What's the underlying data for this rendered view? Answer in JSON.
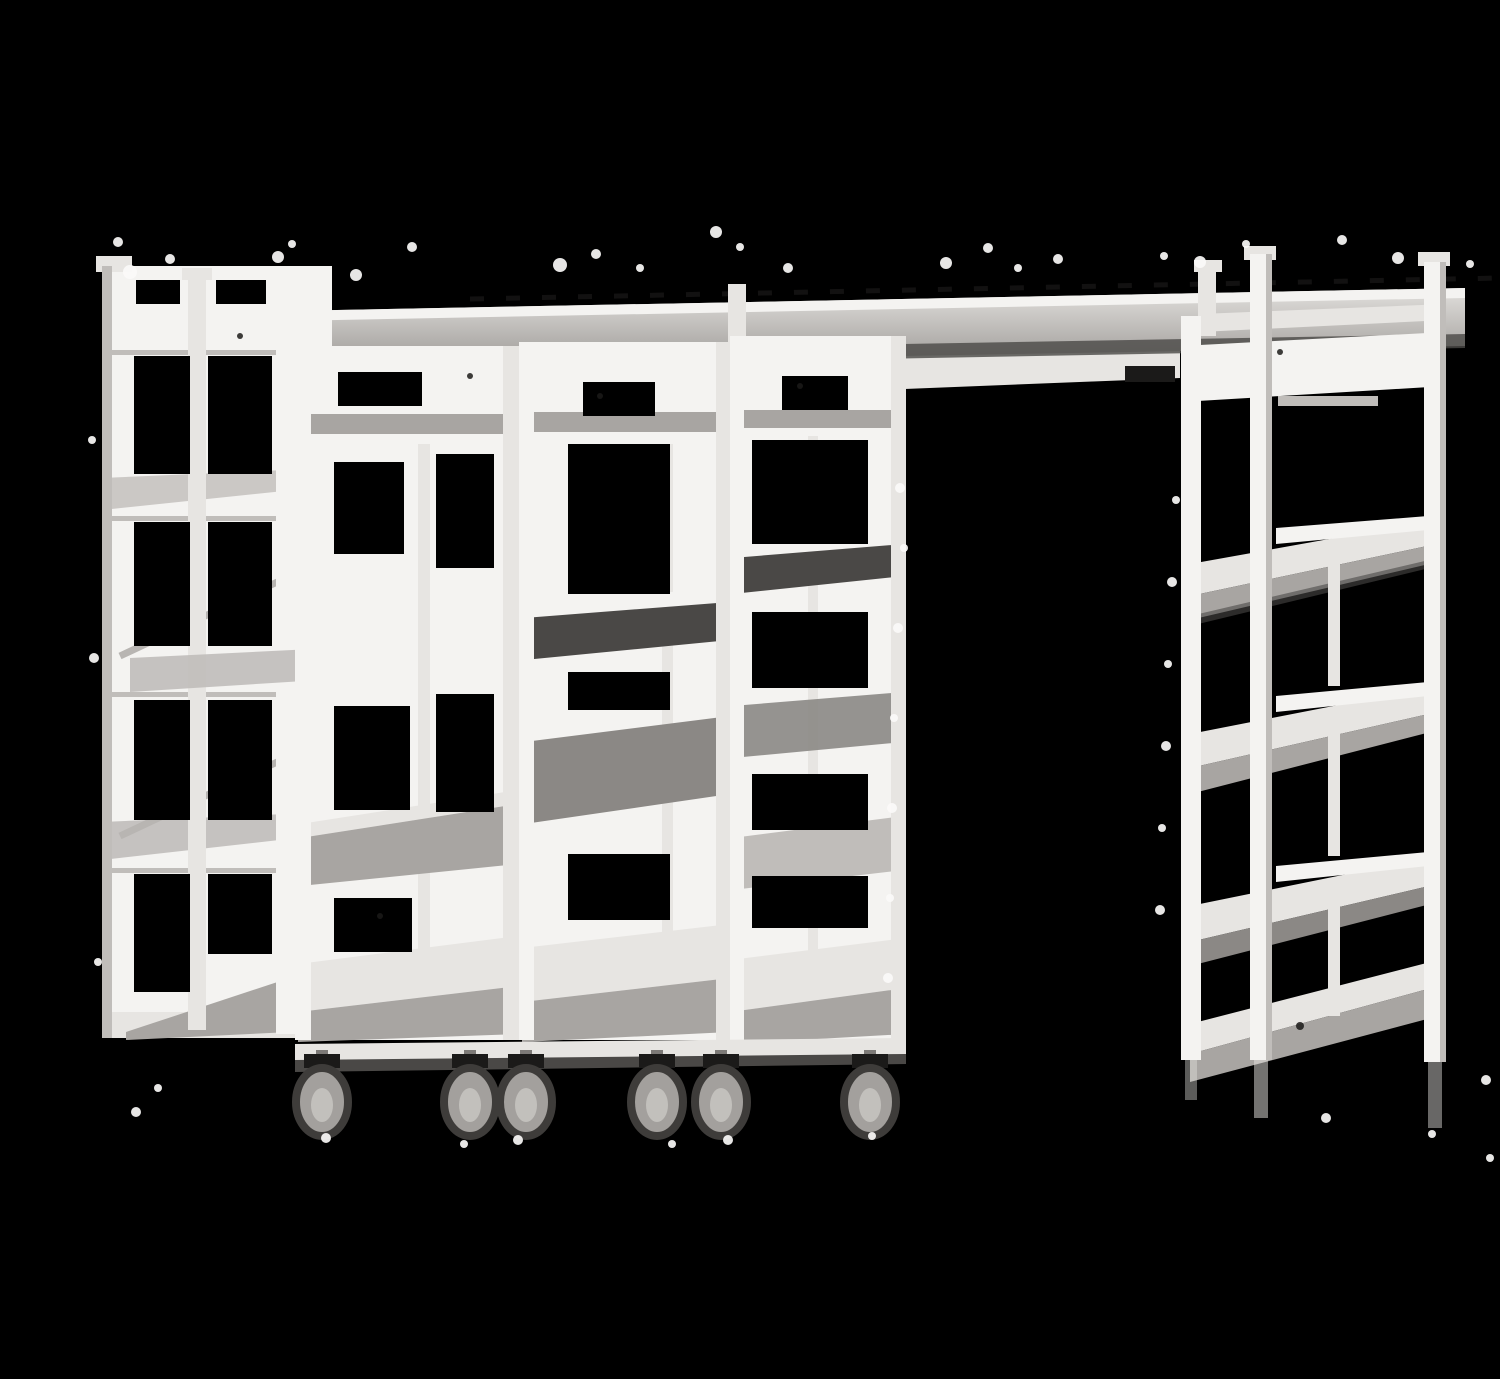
{
  "meta": {
    "kind": "product-photograph",
    "color_mode": "grayscale",
    "width_px": 1500,
    "height_px": 1347
  },
  "scene": {
    "description": "Black-and-white product photograph of a modular high-density mobile shelving system: a long overhead track rail spans the image, connecting a stationary open-frame shelving end unit on the left and a taller stationary end unit on the right. Three wheeled shelf carts are docked side by side beneath the rail, leaving one empty open bay before the right unit. The metal framework is white to light gray against a solid black background; six dark casters hang beneath the carts and white paint-like specks are scattered around the matte edges.",
    "background_color": "#000000"
  },
  "palette": {
    "background_color": "#000000",
    "frame_white": "#f4f3f1",
    "frame_light": "#e7e5e2",
    "frame_mid": "#c0bdba",
    "slab_gray": "#a8a5a2",
    "slab_dark": "#8b8885",
    "shadow_dark": "#4a4846",
    "edge_black": "#1b1a19",
    "speckle_white": "#fbfaf9"
  },
  "components": {
    "top_rail": {
      "label": "overhead track rail"
    },
    "left_unit": {
      "label": "left stationary end shelving unit",
      "shelf_levels": 5
    },
    "carts": [
      {
        "label": "mobile shelf cart 1",
        "shelf_levels": 4
      },
      {
        "label": "mobile shelf cart 2",
        "shelf_levels": 5
      },
      {
        "label": "mobile shelf cart 3",
        "shelf_levels": 5
      }
    ],
    "right_unit": {
      "label": "right stationary end shelving unit",
      "shelf_levels": 5
    },
    "open_bay": {
      "label": "empty docking bay"
    },
    "casters": {
      "label": "caster wheel",
      "count": 6,
      "centers_x": [
        282,
        430,
        486,
        617,
        681,
        830
      ],
      "center_y": 1086
    }
  }
}
